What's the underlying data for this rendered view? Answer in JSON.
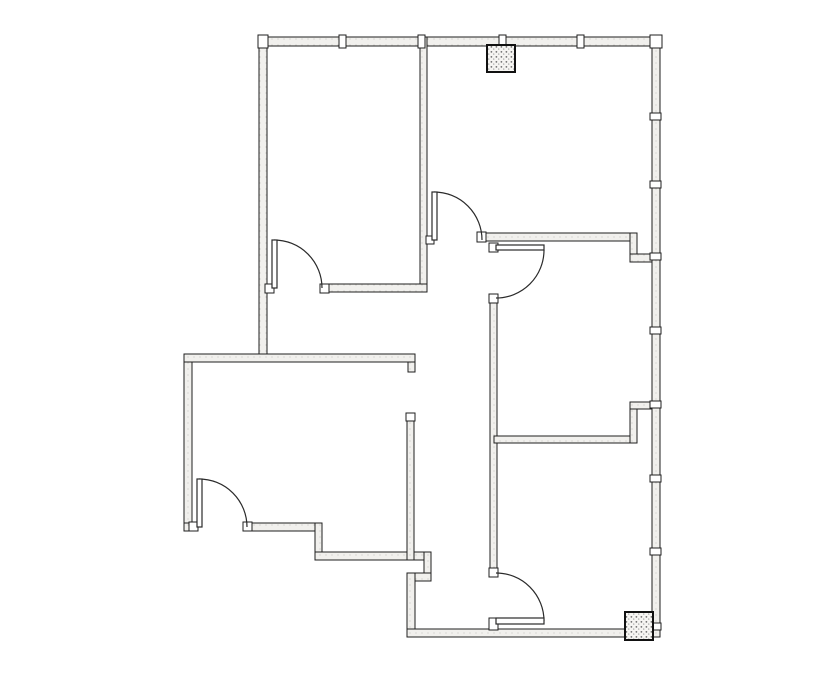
{
  "canvas": {
    "width": 835,
    "height": 678,
    "background": "#ffffff"
  },
  "style": {
    "line_color": "#1f1f1f",
    "wall_fill": "#f1f0ed",
    "wall_speckle": "#c9c8c3",
    "fixture_fill": "#ffffff",
    "door_line_color": "#2a2a2a",
    "shaft_fill": "#f6f5f2",
    "shaft_speckle_dark": "#6e6e6e",
    "shaft_speckle_light": "#a8a8a8",
    "shaft_border": "#111111"
  },
  "floor_plan": {
    "walls": {
      "exterior": [
        {
          "id": "top",
          "x": 259,
          "y": 37,
          "w": 402,
          "h": 9
        },
        {
          "id": "right",
          "x": 652,
          "y": 37,
          "w": 8,
          "h": 600
        },
        {
          "id": "left-upper",
          "x": 259,
          "y": 37,
          "w": 8,
          "h": 317
        },
        {
          "id": "left-lower",
          "x": 184,
          "y": 354,
          "w": 8,
          "h": 177
        },
        {
          "id": "lowerleft-south-stub",
          "x": 184,
          "y": 523,
          "w": 12,
          "h": 8
        },
        {
          "id": "lowerleft-south",
          "x": 245,
          "y": 523,
          "w": 77,
          "h": 8
        },
        {
          "id": "step1-vertical",
          "x": 315,
          "y": 523,
          "w": 7,
          "h": 37
        },
        {
          "id": "low-horizontal",
          "x": 315,
          "y": 552,
          "w": 116,
          "h": 8
        },
        {
          "id": "step2-vertical",
          "x": 424,
          "y": 552,
          "w": 7,
          "h": 29
        },
        {
          "id": "step2-horizontal",
          "x": 407,
          "y": 573,
          "w": 24,
          "h": 8
        },
        {
          "id": "bottomroom-west",
          "x": 407,
          "y": 573,
          "w": 8,
          "h": 64
        },
        {
          "id": "bottom",
          "x": 407,
          "y": 629,
          "w": 253,
          "h": 8
        }
      ],
      "interior": [
        {
          "id": "lowerleft-north",
          "x": 184,
          "y": 354,
          "w": 231,
          "h": 8
        },
        {
          "id": "lowerleft-north-hook",
          "x": 408,
          "y": 362,
          "w": 7,
          "h": 10
        },
        {
          "id": "upperleft-east",
          "x": 420,
          "y": 37,
          "w": 7,
          "h": 255
        },
        {
          "id": "upperleft-south",
          "x": 322,
          "y": 284,
          "w": 105,
          "h": 8
        },
        {
          "id": "upperright-south",
          "x": 483,
          "y": 233,
          "w": 154,
          "h": 8
        },
        {
          "id": "upperright-jog-vert",
          "x": 630,
          "y": 233,
          "w": 7,
          "h": 29
        },
        {
          "id": "upperright-jog-horiz",
          "x": 630,
          "y": 254,
          "w": 22,
          "h": 8
        },
        {
          "id": "hall-east",
          "x": 490,
          "y": 296,
          "w": 7,
          "h": 280
        },
        {
          "id": "room-divider",
          "x": 494,
          "y": 436,
          "w": 143,
          "h": 7
        },
        {
          "id": "divider-jog-vert",
          "x": 630,
          "y": 402,
          "w": 7,
          "h": 41
        },
        {
          "id": "divider-jog-horiz",
          "x": 630,
          "y": 402,
          "w": 22,
          "h": 7
        },
        {
          "id": "lowerleft-east",
          "x": 407,
          "y": 414,
          "w": 7,
          "h": 146
        }
      ]
    },
    "door_jambs": [
      {
        "x": 189,
        "y": 522,
        "w": 9,
        "h": 9
      },
      {
        "x": 243,
        "y": 522,
        "w": 9,
        "h": 9
      },
      {
        "x": 265,
        "y": 284,
        "w": 9,
        "h": 9
      },
      {
        "x": 320,
        "y": 284,
        "w": 9,
        "h": 9
      },
      {
        "x": 426,
        "y": 236,
        "w": 8,
        "h": 8
      },
      {
        "x": 477,
        "y": 232,
        "w": 9,
        "h": 10
      },
      {
        "x": 489,
        "y": 243,
        "w": 9,
        "h": 9
      },
      {
        "x": 489,
        "y": 294,
        "w": 9,
        "h": 9
      },
      {
        "x": 489,
        "y": 568,
        "w": 9,
        "h": 9
      },
      {
        "x": 489,
        "y": 618,
        "w": 9,
        "h": 12
      },
      {
        "x": 406,
        "y": 413,
        "w": 9,
        "h": 8
      }
    ],
    "doors": [
      {
        "id": "upper-left-room-door",
        "leaf": {
          "x": 272,
          "y": 240,
          "w": 5,
          "h": 48
        },
        "arc": {
          "sx": 274,
          "sy": 240,
          "ex": 322,
          "ey": 288,
          "r": 48
        }
      },
      {
        "id": "upper-right-room-door",
        "leaf": {
          "x": 432,
          "y": 192,
          "w": 5,
          "h": 48
        },
        "arc": {
          "sx": 434,
          "sy": 192,
          "ex": 482,
          "ey": 240,
          "r": 48
        }
      },
      {
        "id": "middle-right-room-door",
        "leaf": {
          "x": 496,
          "y": 245,
          "w": 48,
          "h": 5
        },
        "arc": {
          "sx": 544,
          "sy": 250,
          "ex": 496,
          "ey": 298,
          "r": 48
        }
      },
      {
        "id": "lower-left-room-door",
        "leaf": {
          "x": 197,
          "y": 479,
          "w": 5,
          "h": 48
        },
        "arc": {
          "sx": 199,
          "sy": 479,
          "ex": 247,
          "ey": 527,
          "r": 48
        }
      },
      {
        "id": "lower-right-room-door",
        "leaf": {
          "x": 496,
          "y": 618,
          "w": 48,
          "h": 6
        },
        "arc": {
          "sx": 496,
          "sy": 573,
          "ex": 544,
          "ey": 621,
          "r": 48
        }
      }
    ],
    "window_mullions": {
      "top_wall_x": [
        342,
        421,
        502,
        580
      ],
      "top_wall_band": {
        "y": 35,
        "w": 7,
        "h": 13
      },
      "right_wall_y": [
        116,
        184,
        256,
        330,
        404,
        478,
        551,
        626
      ],
      "right_wall_band": {
        "x": 650,
        "w": 11,
        "h": 7
      }
    },
    "corner_posts": [
      {
        "id": "top-left-corner-post",
        "x": 258,
        "y": 35,
        "w": 10,
        "h": 13
      },
      {
        "id": "top-right-corner-post",
        "x": 650,
        "y": 35,
        "w": 12,
        "h": 13
      }
    ],
    "shafts": [
      {
        "id": "top-shaft-column",
        "x": 487,
        "y": 45,
        "w": 28,
        "h": 27
      },
      {
        "id": "bottom-right-shaft-column",
        "x": 625,
        "y": 612,
        "w": 28,
        "h": 28
      }
    ]
  }
}
